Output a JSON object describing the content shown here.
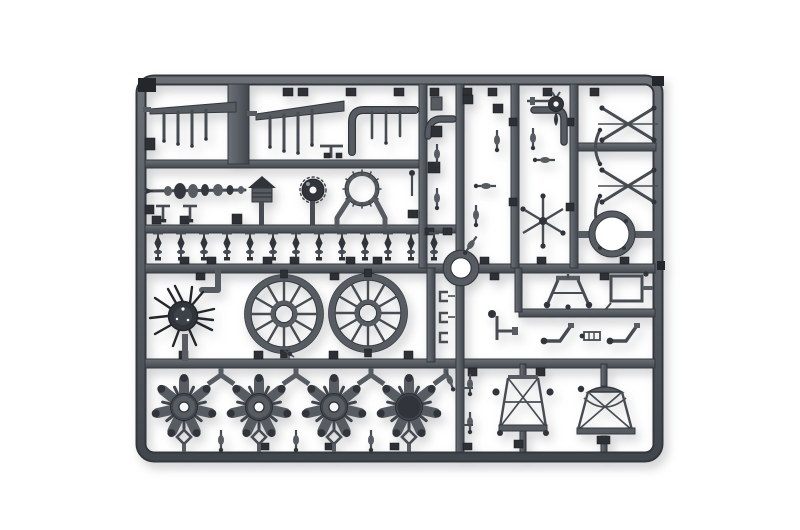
{
  "image": {
    "type": "product photograph",
    "subject": "Injection-molded plastic model kit sprue (parts tree) of a biplane aircraft kit, dark grey styrene on a white studio background",
    "background": "plain white",
    "plastic_finish": "matte dark grey"
  },
  "colors": {
    "page-bg": "#ffffff",
    "plastic": "#575c63",
    "plastic-dark": "#34383e",
    "plastic-deep": "#23262b",
    "plastic-light": "#9298a0",
    "gate": "#2d3136",
    "spoke": "#474c53",
    "part-dark": "#31353b",
    "hole": "#f6f7f8"
  },
  "parts_inventory": [
    {
      "name": "wing-spar-comb",
      "count": 2
    },
    {
      "name": "exhaust-elbow-pipe",
      "count": 3
    },
    {
      "name": "crankshaft",
      "count": 1
    },
    {
      "name": "ribbed-mushroom-cap",
      "count": 1
    },
    {
      "name": "toothed-disc",
      "count": 1
    },
    {
      "name": "ticked-cowl-ring",
      "count": 1
    },
    {
      "name": "finial-pin",
      "count": 13
    },
    {
      "name": "spiked-hub",
      "count": 1
    },
    {
      "name": "spoked-wheel",
      "count": 2
    },
    {
      "name": "cowl-ring-small",
      "count": 1
    },
    {
      "name": "cowl-ring-large",
      "count": 1
    },
    {
      "name": "six-arm-star",
      "count": 1
    },
    {
      "name": "x-brace-strut",
      "count": 2
    },
    {
      "name": "bow-strut",
      "count": 2
    },
    {
      "name": "radial-engine",
      "count": 4
    },
    {
      "name": "engine-mount-frame",
      "count": 2
    },
    {
      "name": "tail-wheel",
      "count": 1
    },
    {
      "name": "small-detail-pin",
      "count": 22
    }
  ]
}
